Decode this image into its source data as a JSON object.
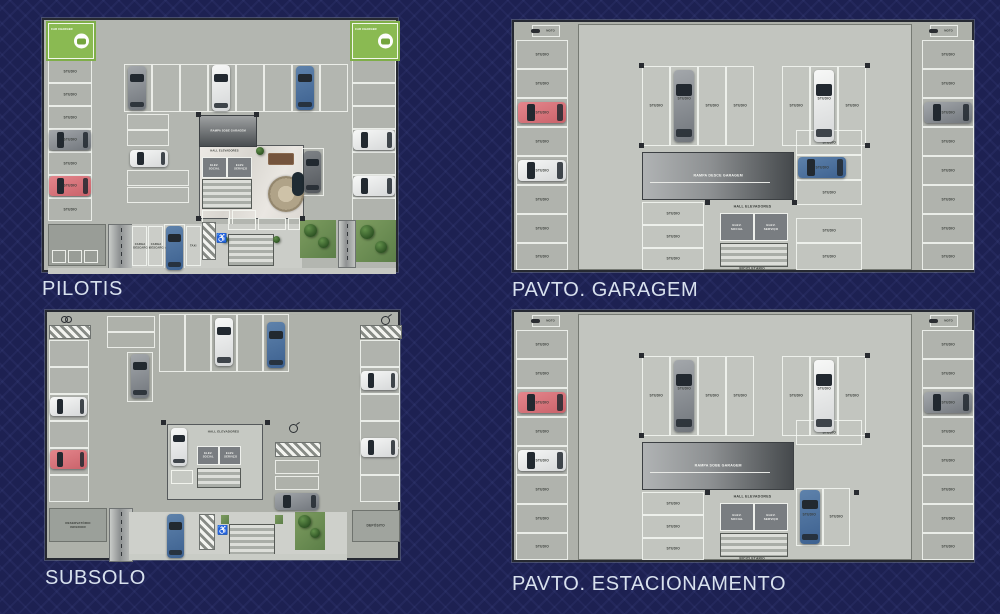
{
  "slide": {
    "background_color": "#1d2152",
    "title_color": "#d8e1ee"
  },
  "plans": {
    "pilotis": {
      "title": "PILOTIS"
    },
    "garagem": {
      "title": "PAVTO. GARAGEM"
    },
    "subsolo": {
      "title": "SUBSOLO"
    },
    "estacionamento": {
      "title": "PAVTO. ESTACIONAMENTO"
    }
  },
  "labels": {
    "studio": "STUDIO",
    "moto": "MOTO",
    "car_charger": "CAR CHARGER",
    "rampa_sobe_garagem": "RAMPA SOBE GARAGEM",
    "rampa_desce_garagem": "RAMPA DESCE GARAGEM",
    "hall_elevadores": "HALL ELEVADORES",
    "elev_social": "ELEV. SOCIAL",
    "elev_servico": "ELEV. SERVIÇO",
    "bicicletario": "BICICLETÁRIO",
    "reservatorio_inferior": "RESERVATÓRIO INFERIOR",
    "deposito": "DEPÓSITO",
    "carga_descarga": "CARGA DESCARGA",
    "taxi": "TAXI"
  },
  "icons": {
    "accessibility": "♿"
  },
  "colors": {
    "charger_green": "#8aba52",
    "car_red": "#d96f75",
    "car_blue": "#48699b",
    "car_white": "#f0f1f1",
    "car_gray": "#8d9195",
    "grass_green": "#5e814a"
  }
}
